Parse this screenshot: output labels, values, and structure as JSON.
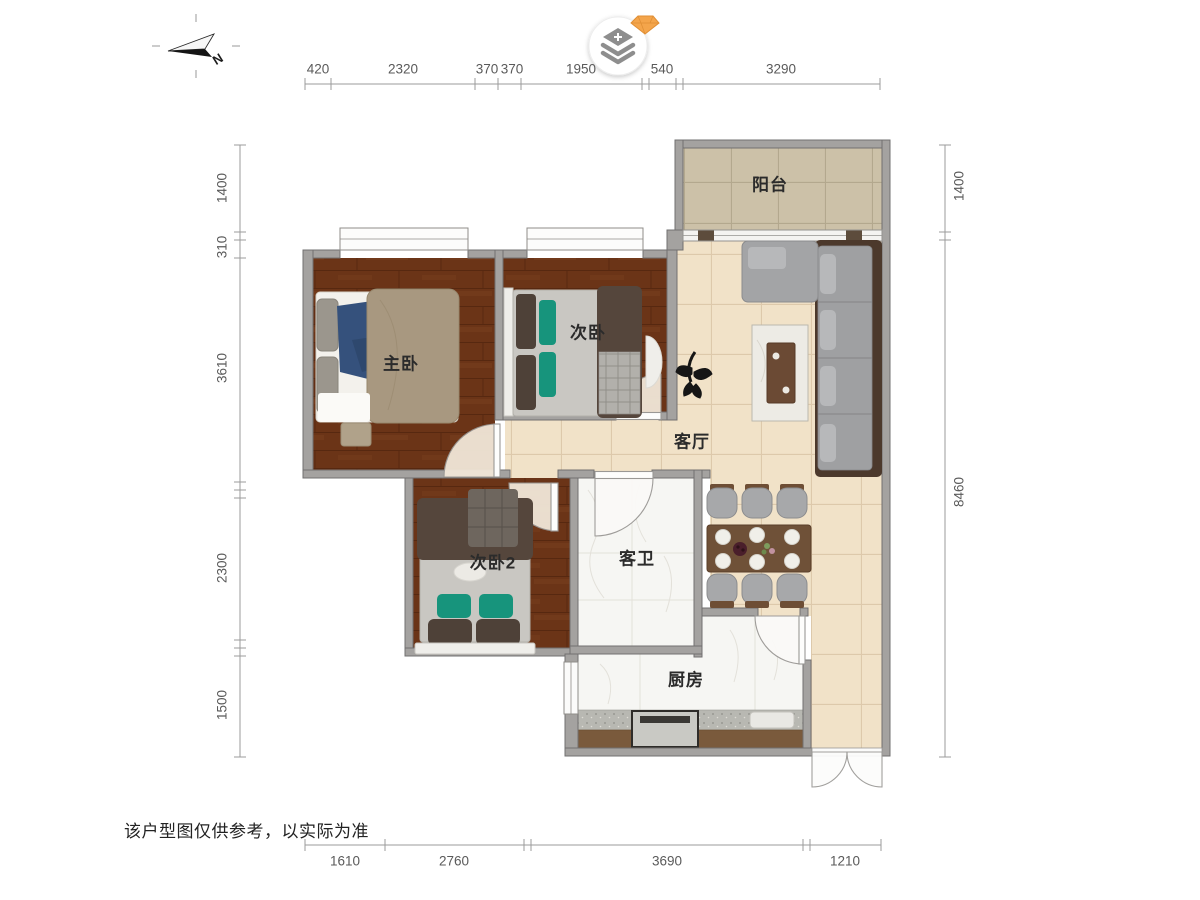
{
  "note": "该户型图仅供参考，以实际为准",
  "compass": {
    "north_label": "N"
  },
  "rooms": {
    "balcony": "阳台",
    "master_bedroom": "主卧",
    "bedroom_2": "次卧",
    "bedroom_3": "次卧2",
    "living_room": "客厅",
    "guest_bathroom": "客卫",
    "kitchen": "厨房"
  },
  "dimensions": {
    "top": [
      "420",
      "2320",
      "370",
      "370",
      "1950",
      "540",
      "3290"
    ],
    "bottom": [
      "1610",
      "2760",
      "3690",
      "1210"
    ],
    "left": [
      "1400",
      "310",
      "3610",
      "2300",
      "1500"
    ],
    "right": [
      "1400",
      "8460"
    ]
  },
  "colors": {
    "wall": "#a4a2a0",
    "wood_floor": "#6b3417",
    "tile_floor": "#f1e2c8",
    "balcony_tile": "#ccc1a8",
    "marble_floor": "#f6f6f3",
    "sofa_gray": "#9fa0a2",
    "teal_pillow": "#17947c",
    "gem": "#f4a54b"
  }
}
